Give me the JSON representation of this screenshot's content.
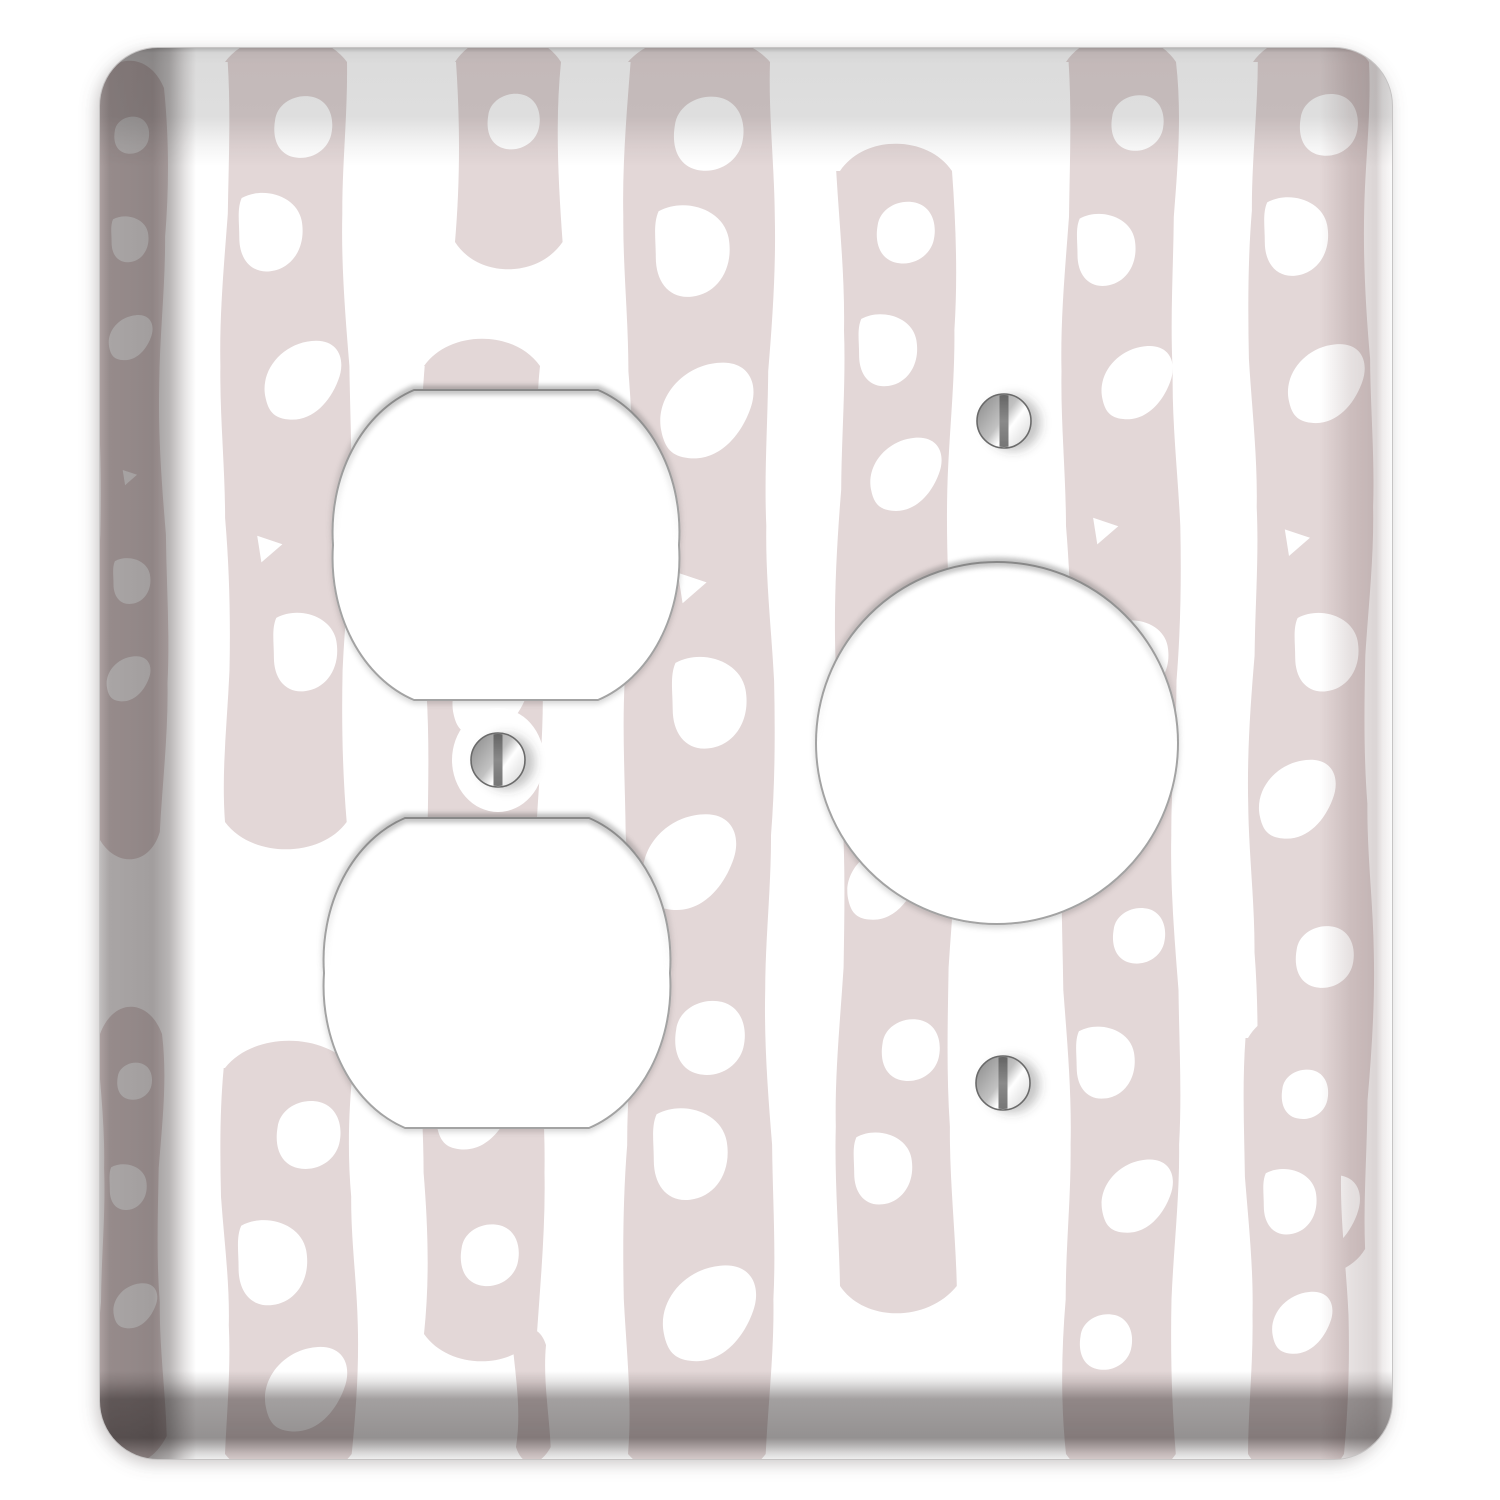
{
  "product": {
    "name": "Two-gang wall plate cover with duplex outlet cutouts and single receptacle cutout",
    "pattern_name": "hand-drawn ladder stripes",
    "background_color": "#ffffff"
  },
  "plate": {
    "x": 100,
    "y": 48,
    "width": 1292,
    "height": 1411,
    "corner_radius": 58,
    "face_color": "#ffffff",
    "outline_color": "#c6c4c4"
  },
  "bevel_colors": {
    "top": "#dcdcdc",
    "left": "#a9a5a5",
    "right": "#e6e1e1",
    "bottom": "#a3a0a0"
  },
  "pattern": {
    "stripe_color": "#e3d7d7",
    "hole_color": "#ffffff",
    "stripes": [
      {
        "x": 96,
        "w": 68,
        "y0": 62,
        "y1": 858,
        "seed": 1
      },
      {
        "x": 100,
        "w": 62,
        "y0": 1008,
        "y1": 1462,
        "seed": 2
      },
      {
        "x": 225,
        "w": 122,
        "y0": 36,
        "y1": 848,
        "seed": 3
      },
      {
        "x": 225,
        "w": 128,
        "y0": 1042,
        "y1": 1480,
        "seed": 4
      },
      {
        "x": 455,
        "w": 106,
        "y0": 36,
        "y1": 268,
        "seed": 11
      },
      {
        "x": 424,
        "w": 116,
        "y0": 340,
        "y1": 1360,
        "seed": 5
      },
      {
        "x": 516,
        "w": 30,
        "y0": 1330,
        "y1": 1462,
        "seed": 12,
        "plain": true
      },
      {
        "x": 628,
        "w": 142,
        "y0": 36,
        "y1": 1480,
        "seed": 6
      },
      {
        "x": 840,
        "w": 112,
        "y0": 145,
        "y1": 1312,
        "seed": 7
      },
      {
        "x": 1066,
        "w": 110,
        "y0": 36,
        "y1": 1480,
        "seed": 8
      },
      {
        "x": 1253,
        "w": 116,
        "y0": 36,
        "y1": 1275,
        "seed": 9
      },
      {
        "x": 1248,
        "w": 96,
        "y0": 1012,
        "y1": 1480,
        "seed": 10
      }
    ]
  },
  "openings": [
    {
      "kind": "duplex",
      "cx": 506,
      "cy": 545,
      "r": 173,
      "half_height": 155,
      "flat_half_width": 92
    },
    {
      "kind": "duplex",
      "cx": 497,
      "cy": 973,
      "r": 173,
      "half_height": 155,
      "flat_half_width": 92
    },
    {
      "kind": "round",
      "cx": 997,
      "cy": 743,
      "r": 181
    }
  ],
  "opening_style": {
    "fill": "#ffffff",
    "outline": "#a3a3a3"
  },
  "screws": [
    {
      "cx": 1004,
      "cy": 421,
      "r": 27
    },
    {
      "cx": 498,
      "cy": 760,
      "r": 27
    },
    {
      "cx": 1003,
      "cy": 1083,
      "r": 27
    }
  ],
  "screw_colors": {
    "metal_dark": "#8f8f8f",
    "metal_light": "#ffffff",
    "slot": "#8a8a8a",
    "ring": "#6a6a6a"
  }
}
